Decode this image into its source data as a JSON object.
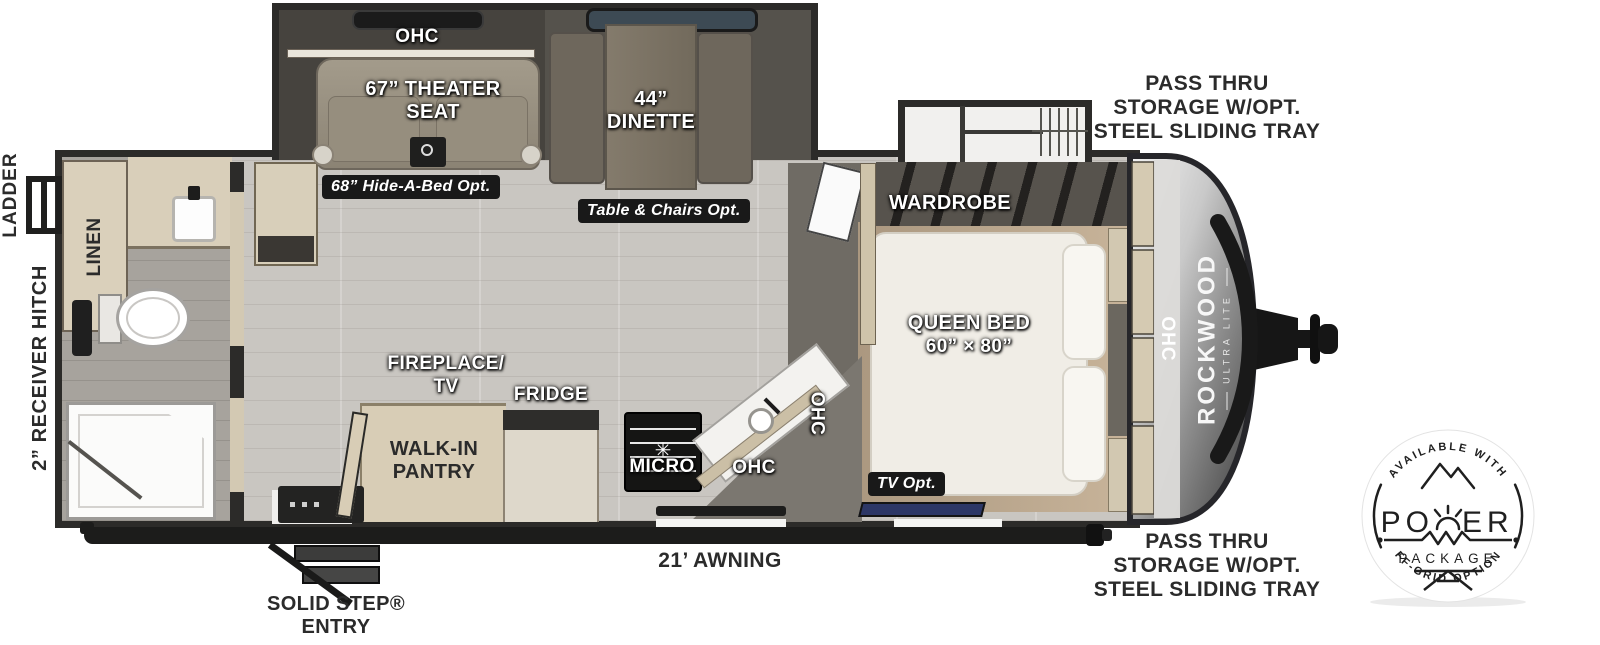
{
  "floorplan": {
    "branding": {
      "brand": "ROCKWOOD",
      "series": "ULTRA LITE"
    },
    "labels": {
      "ohc": "OHC",
      "theater_seat": "67” THEATER\nSEAT",
      "hide_a_bed": "68” Hide-A-Bed Opt.",
      "dinette": "44”\nDINETTE",
      "table_chairs": "Table & Chairs Opt.",
      "wardrobe": "WARDROBE",
      "queen_bed": "QUEEN BED",
      "queen_size": "60” × 80”",
      "tv_opt": "TV Opt.",
      "fireplace_tv": "FIREPLACE/\nTV",
      "fridge": "FRIDGE",
      "walk_in_pantry": "WALK-IN\nPANTRY",
      "micro": "MICRO",
      "linen": "LINEN",
      "ladder": "LADDER",
      "receiver_hitch": "2” RECEIVER HITCH",
      "pass_thru": "PASS THRU\nSTORAGE W/OPT.\nSTEEL SLIDING TRAY",
      "awning": "21’ AWNING",
      "solid_step": "SOLID STEP®\nENTRY"
    },
    "power_badge": {
      "top_arc": "AVAILABLE WITH",
      "word_start": "PO",
      "word_end": "ER",
      "package": "PACKAGE",
      "bottom_arc": "OFF-GRID OPTIONS"
    },
    "colors": {
      "wall": "#2c2b29",
      "floor": "#c9c6c1",
      "cabinet": "#d7ccb6",
      "slide_floor": "#46433e",
      "chrome_nose": "#9a9a9a",
      "tv_accent": "#2d3766",
      "badge_ink": "#1f1f1f",
      "label_white": "#ffffff",
      "label_dark": "#2b2b2b"
    }
  }
}
